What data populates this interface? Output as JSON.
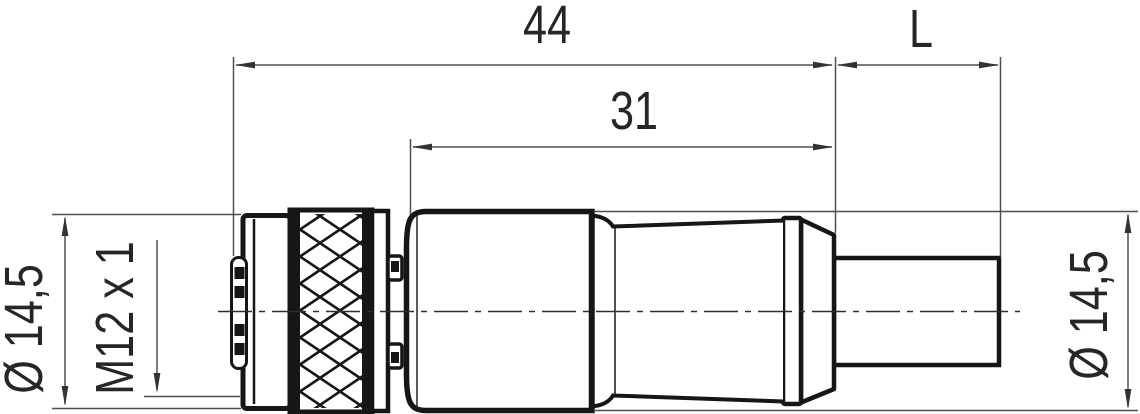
{
  "drawing": {
    "kind": "technical-dimension-drawing",
    "part": "M12 circular connector with molded cable",
    "dimensions": {
      "overall_length": "44",
      "body_length": "31",
      "cable_length": "L",
      "front_diameter": "Ø 14,5",
      "thread": "M12 x 1",
      "rear_diameter": "Ø 14,5"
    },
    "colors": {
      "background": "#ffffff",
      "part_outline": "#161616",
      "dimension_lines": "#4f4f4f",
      "text": "#262626"
    }
  }
}
